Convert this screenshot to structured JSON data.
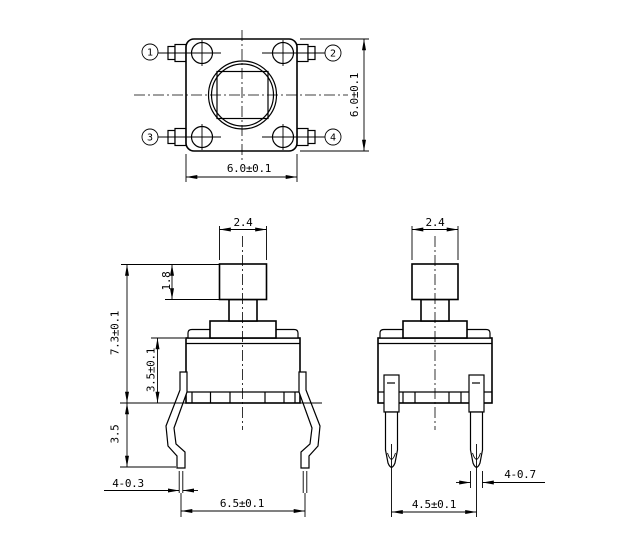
{
  "drawing": {
    "type": "mechanical-dimension-drawing",
    "subject": "tactile-push-button-switch",
    "colors": {
      "line_color": "#000000",
      "background": "#ffffff"
    }
  },
  "top_view": {
    "pin_labels": {
      "pin1": "1",
      "pin2": "2",
      "pin3": "3",
      "pin4": "4"
    },
    "dimensions": {
      "width": "6.0±0.1",
      "height": "6.0±0.1"
    }
  },
  "front_view": {
    "dimensions": {
      "button_width": "2.4",
      "button_height": "1.8",
      "total_height": "7.3±0.1",
      "body_height": "3.5±0.1",
      "lead_length": "3.5",
      "lead_thickness": "4-0.3",
      "lead_span": "6.5±0.1"
    }
  },
  "side_view": {
    "dimensions": {
      "button_width": "2.4",
      "lead_thickness": "4-0.7",
      "lead_pitch": "4.5±0.1"
    }
  }
}
